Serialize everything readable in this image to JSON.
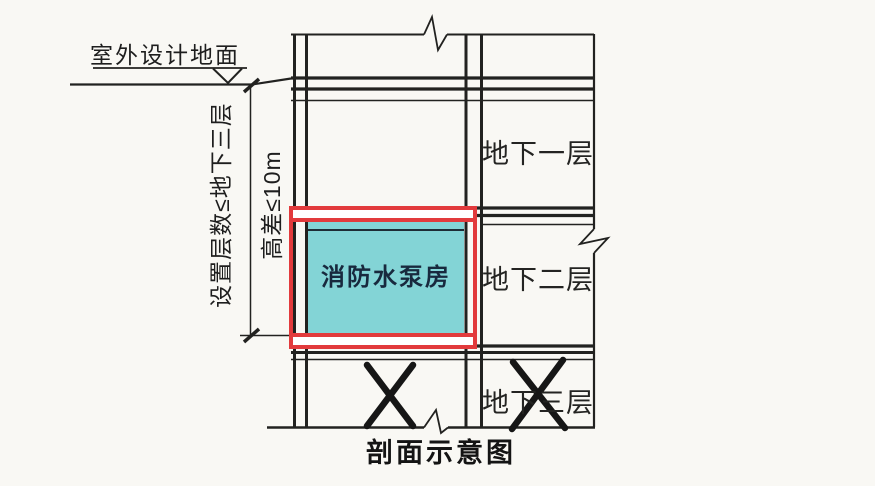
{
  "diagram": {
    "title": "剖面示意图",
    "ground_label": "室外设计地面",
    "constraint_levels": "设置层数≤地下三层",
    "constraint_height": "高差≤10m",
    "room_label": "消防水泵房",
    "floors": [
      {
        "label": "地下一层",
        "crossed_out": false
      },
      {
        "label": "地下二层",
        "crossed_out": false
      },
      {
        "label": "地下三层",
        "crossed_out": true
      }
    ],
    "colors": {
      "highlight_red": "#e23a3c",
      "room_fill": "#83d4d6",
      "line_black": "#222220",
      "paper": "#f9f8f4"
    }
  }
}
